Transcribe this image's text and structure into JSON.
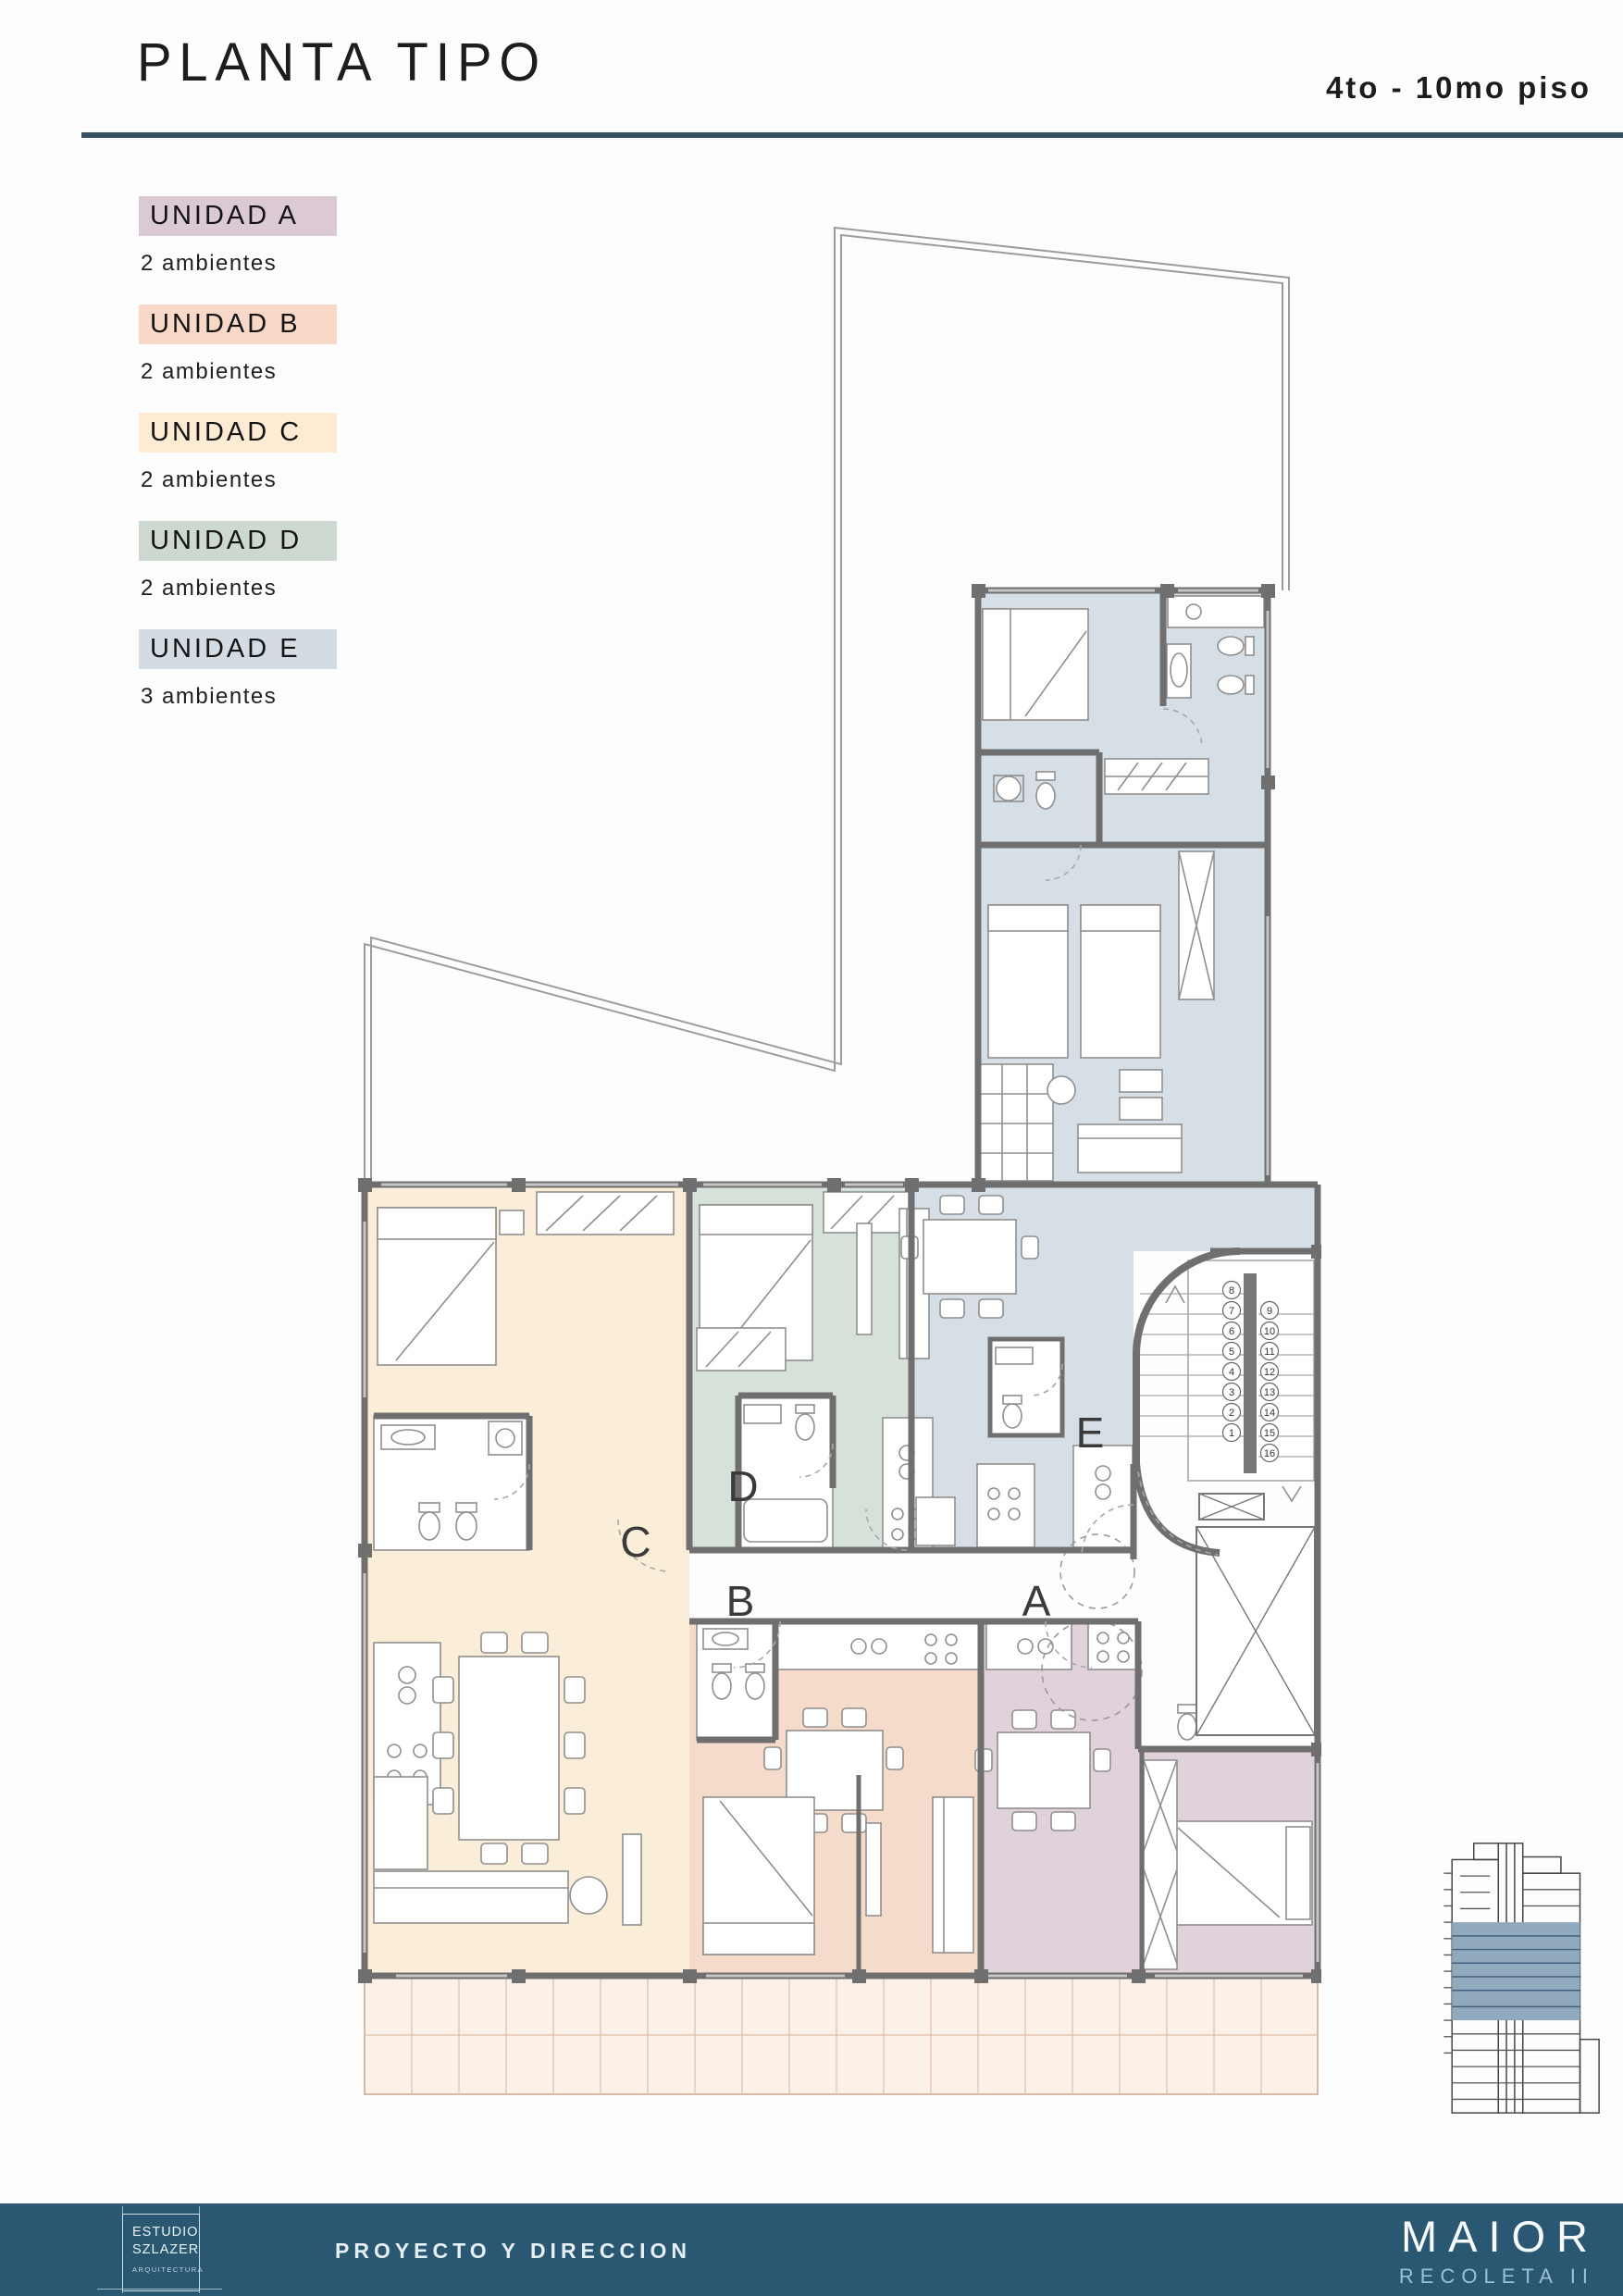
{
  "header": {
    "title": "PLANTA TIPO",
    "floors": "4to - 10mo piso"
  },
  "legend": {
    "items": [
      {
        "label": "UNIDAD A",
        "desc": "2 ambientes",
        "color": "#dbc9d4"
      },
      {
        "label": "UNIDAD B",
        "desc": "2 ambientes",
        "color": "#f8d8c6"
      },
      {
        "label": "UNIDAD C",
        "desc": "2 ambientes",
        "color": "#fdebd3"
      },
      {
        "label": "UNIDAD D",
        "desc": "2 ambientes",
        "color": "#ccd8d0"
      },
      {
        "label": "UNIDAD E",
        "desc": "3 ambientes",
        "color": "#d3dce3"
      }
    ]
  },
  "plan": {
    "units": {
      "a": "A",
      "b": "B",
      "c": "C",
      "d": "D",
      "e": "E"
    },
    "colors": {
      "a": "#e0d1db",
      "b": "#f5dcca",
      "c": "#fbeed8",
      "d": "#d6e1d9",
      "e": "#d7dfe6",
      "terrace": "#fbf1e9"
    },
    "stairs": {
      "left": [
        "8",
        "7",
        "6",
        "5",
        "4",
        "3",
        "2",
        "1"
      ],
      "right": [
        "9",
        "10",
        "11",
        "12",
        "13",
        "14",
        "15",
        "16"
      ]
    }
  },
  "footer": {
    "bar_color": "#2a5873",
    "studio_line1": "ESTUDIO",
    "studio_line2": "SZLAZER",
    "studio_sub": "ARQUITECTURA",
    "role": "PROYECTO Y DIRECCION",
    "brand": "MAIOR",
    "brand_sub": "RECOLETA II"
  }
}
